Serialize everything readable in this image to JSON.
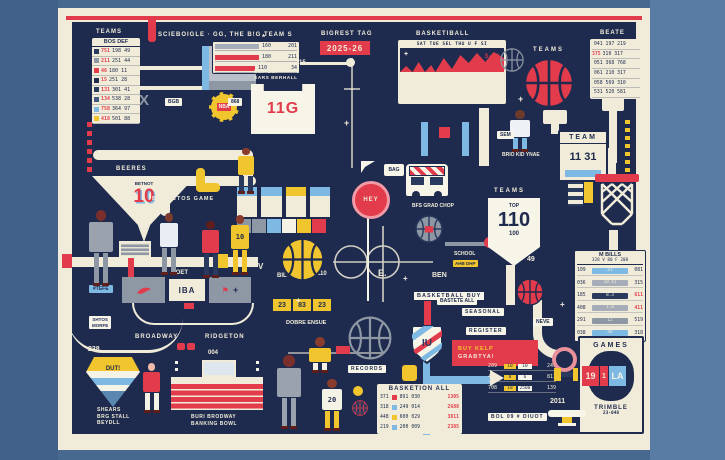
{
  "palette": {
    "bg": "#48698f",
    "bg_left": "#41618a",
    "bg_right": "#587ca4",
    "cream": "#f1ecd9",
    "navy": "#1e2b4e",
    "navy2": "#2a3a5e",
    "red": "#e23b4b",
    "yellow": "#f1c52e",
    "blue": "#7db9e3",
    "gray": "#a6adb8",
    "slate": "#8e97a4",
    "white": "#f7f4e8",
    "pink": "#f09aa5"
  },
  "top_left": {
    "title": "TEAMS",
    "header": "BOS DEF",
    "rows": [
      {
        "sw": "#2a3a5e",
        "n": "751",
        "v": "198 49"
      },
      {
        "sw": "#8e97a4",
        "n": "211",
        "v": "251 44"
      },
      {
        "sw": "#e23b4b",
        "n": "46",
        "v": "180 11"
      },
      {
        "sw": "#1e2b4e",
        "n": "15",
        "v": "251 28"
      },
      {
        "sw": "#2a3a5e",
        "n": "131",
        "v": "301 41"
      },
      {
        "sw": "#44597e",
        "n": "134",
        "v": "538 28"
      },
      {
        "sw": "#7db9e3",
        "n": "758",
        "v": "364 97"
      },
      {
        "sw": "#f1c52e",
        "n": "418",
        "v": "501 88"
      }
    ]
  },
  "schedule": "SCIEBOIGLE ·",
  "big_team": {
    "title": "GG, THE B!G TEAM S",
    "rows": [
      {
        "w": 44,
        "c": "#a6adb8",
        "label": "160",
        "value": "201"
      },
      {
        "w": 44,
        "c": "#e23b4b",
        "label": "180",
        "value": "211"
      },
      {
        "w": 40,
        "c": "#e23b4b",
        "label": "110",
        "value": "34"
      }
    ]
  },
  "bigrest": {
    "label": "BIGREST TAG",
    "value": "2025-26"
  },
  "jersey": {
    "cap1": "BGF BGI",
    "cap2": "SARS BERHALL",
    "num": "11G",
    "ln": "20",
    "rn": "15"
  },
  "nba": "NBA",
  "calendar": {
    "title": "BASKETIBALL",
    "days": "SAT TUE SEL THU U F SI",
    "note": "3-42",
    "rows": [
      "209 211 18 64 241 688",
      "304 511 56 89 408 257",
      "519 529 21 25 239 259",
      "060 358 48 81 340 201"
    ]
  },
  "teams_ball": "TEAMS",
  "beate": {
    "title": "BEATE",
    "rows": [
      {
        "pre": "",
        "rest": "041 197 219"
      },
      {
        "pre": "375",
        "rest": "310 317"
      },
      {
        "pre": "",
        "rest": "051 368 768"
      },
      {
        "pre": "",
        "rest": "061 210 317"
      },
      {
        "pre": "",
        "rest": "058 569 310"
      },
      {
        "pre": "",
        "rest": "531 520 581"
      }
    ]
  },
  "team_score": {
    "title": "TEAM",
    "score": "11 31"
  },
  "player_tag": "BRIO KID YNAE",
  "funnel": {
    "cap": "BEERES",
    "sub": "BETNOT",
    "num": "10"
  },
  "ban_etos": "BAN! ETOS GAME",
  "hey": "HEY",
  "bag": "BAG",
  "bus_label": "BFS GRAD CHOP",
  "tag110": {
    "title": "TEAMS",
    "top": "TOP",
    "num": "110",
    "bottom": "100"
  },
  "m_bills": {
    "title": "M BILLS",
    "head": "328 V 80 F 208",
    "rows": [
      {
        "l": "109",
        "c": "41",
        "cc": "#7db9e3",
        "r": "081"
      },
      {
        "l": "036",
        "c": "10.41",
        "cc": "#a6adb8",
        "r": "315"
      },
      {
        "l": "185",
        "c": "8.3",
        "cc": "#2a3a5e",
        "r": "611",
        "red": true
      },
      {
        "l": "408",
        "c": "1.0",
        "cc": "#a6adb8",
        "r": "411",
        "red": true
      },
      {
        "l": "291",
        "c": "12",
        "cc": "#8e97a4",
        "r": "519"
      },
      {
        "l": "038",
        "c": "40",
        "cc": "#7db9e3",
        "r": "318"
      }
    ]
  },
  "ball_labels": {
    "left": "BIL",
    "right": "110"
  },
  "buy_label": "BASKETBALL BUY",
  "school": {
    "line": "SCHOOL",
    "tag": "AHB DHP"
  },
  "records": "RECORDS",
  "score_strip": {
    "a": "23",
    "b": "83",
    "c": "23"
  },
  "dobre": "DOBRE ENSUE",
  "shield_text": "IU",
  "seasonal": "SEASONAL",
  "register": "REGISTER",
  "banner": {
    "l1": "BUY KELP",
    "l2": "GRABTYA!"
  },
  "legend": {
    "title": "BASKETION ALL",
    "rows": [
      {
        "a": "371",
        "sw": "#e23b4b",
        "b": "891",
        "c": "030",
        "d": "1305"
      },
      {
        "a": "318",
        "sw": "#7db9e3",
        "b": "249",
        "c": "014",
        "d": "2688"
      },
      {
        "a": "448",
        "sw": "#f1c52e",
        "b": "600",
        "c": "029",
        "d": "3811"
      },
      {
        "a": "219",
        "sw": "#7db9e3",
        "b": "200",
        "c": "009",
        "d": "2385"
      }
    ]
  },
  "stat_bars": [
    {
      "a": "209",
      "t1": "10",
      "t2": "10",
      "d": "249"
    },
    {
      "a": "461",
      "t1": "8",
      "t2": "6",
      "d": "811"
    },
    {
      "a": "708",
      "t1": "18",
      "t2": "2508",
      "d": "139"
    }
  ],
  "games": {
    "title": "GAMES",
    "home": "19",
    "mid": "1",
    "away": "LA",
    "note": "TRIMBLE",
    "code": "23-048"
  },
  "court": {
    "label": "FOET",
    "center": "IBA",
    "left": "BROADWAY",
    "right": "RIDGETON"
  },
  "diamond": "DUT!",
  "bottom_left_text": [
    "SHEARS",
    "BRG STALL",
    "BEYDLL"
  ],
  "bottom_right_text": [
    "BURI BRODWAY",
    "BANKING BOWL"
  ],
  "bol": "BOL 09 # DIUOT",
  "chip_blue": "#TEFE",
  "sign": [
    "SHTOS",
    "MORFE"
  ],
  "figures": [
    {
      "x": 86,
      "y": 210,
      "w": 30,
      "h": 76,
      "skin": "#7a2f2c",
      "shirt": "#9aa3ad",
      "pants": "#8e97a4",
      "num": ""
    },
    {
      "x": 157,
      "y": 213,
      "w": 24,
      "h": 62,
      "skin": "#7a3a2e",
      "shirt": "#e8eef4",
      "pants": "#8e97a4",
      "num": ""
    },
    {
      "x": 199,
      "y": 221,
      "w": 23,
      "h": 57,
      "skin": "#5e1f1c",
      "shirt": "#e23b4b",
      "pants": "#2a3a5e",
      "num": ""
    },
    {
      "x": 228,
      "y": 215,
      "w": 24,
      "h": 60,
      "skin": "#8a3c2c",
      "shirt": "#f1c52e",
      "pants": "#f1c52e",
      "num": "10"
    },
    {
      "x": 236,
      "y": 148,
      "w": 20,
      "h": 46,
      "skin": "#8a3c2c",
      "shirt": "#f1c52e",
      "pants": "#2a3a5e",
      "num": ""
    },
    {
      "x": 507,
      "y": 110,
      "w": 26,
      "h": 42,
      "skin": "#6b3a2a",
      "shirt": "#eef2f6",
      "pants": "#7db9e3",
      "num": ""
    },
    {
      "x": 273,
      "y": 355,
      "w": 32,
      "h": 74,
      "skin": "#7a2f2c",
      "shirt": "#9aa3ad",
      "pants": "#9aa3ad",
      "num": ""
    },
    {
      "x": 319,
      "y": 379,
      "w": 26,
      "h": 52,
      "skin": "#8a3c2c",
      "shirt": "#f5f2e6",
      "pants": "#f1c52e",
      "num": "20"
    },
    {
      "x": 306,
      "y": 337,
      "w": 28,
      "h": 36,
      "skin": "#8a3c2c",
      "shirt": "#f1c52e",
      "pants": "#f5f2e6",
      "num": ""
    },
    {
      "x": 141,
      "y": 363,
      "w": 21,
      "h": 50,
      "skin": "#f0b9a8",
      "shirt": "#e23b4b",
      "pants": "#f5f2e6",
      "num": ""
    }
  ],
  "balls": [
    {
      "x": 523,
      "y": 57,
      "d": 52,
      "fill": "#e23b4b",
      "seam": "#1e2b4e"
    },
    {
      "x": 500,
      "y": 48,
      "d": 24,
      "fill": "none",
      "seam": "#8e97a4"
    },
    {
      "x": 280,
      "y": 237,
      "d": 45,
      "fill": "#f1c52e",
      "seam": "#1e2b4e"
    },
    {
      "x": 415,
      "y": 215,
      "d": 28,
      "fill": "#8e97a4",
      "seam": "#2a3a5e",
      "patch": "#e23b4b"
    },
    {
      "x": 348,
      "y": 316,
      "d": 44,
      "fill": "none",
      "seam": "#8e97a4"
    },
    {
      "x": 352,
      "y": 400,
      "d": 16,
      "fill": "#2a3a5e",
      "seam": "#e23b4b"
    },
    {
      "x": 516,
      "y": 278,
      "d": 28,
      "fill": "#e23b4b",
      "seam": "#1e2b4e"
    }
  ],
  "pipes": [
    {
      "x": 66,
      "y": 16,
      "w": 576,
      "h": 4,
      "c": "#e23b4b"
    },
    {
      "x": 148,
      "y": 16,
      "w": 8,
      "h": 26,
      "c": "#e23b4b",
      "r": "3px"
    },
    {
      "x": 87,
      "y": 122,
      "w": 5,
      "h": 52,
      "c": "repeating-linear-gradient(180deg,#e23b4b 0 5px,rgba(0,0,0,0) 5px 9px)"
    },
    {
      "x": 140,
      "y": 66,
      "w": 62,
      "h": 4,
      "c": "#f1ecd9"
    },
    {
      "x": 140,
      "y": 86,
      "w": 62,
      "h": 4,
      "c": "#f1ecd9"
    },
    {
      "x": 294,
      "y": 62,
      "w": 54,
      "h": 3,
      "c": "#f1ecd9"
    },
    {
      "x": 346,
      "y": 58,
      "w": 9,
      "h": 9,
      "c": "#f1ecd9",
      "r": "50%"
    },
    {
      "x": 93,
      "y": 150,
      "w": 160,
      "h": 10,
      "c": "#f1ecd9",
      "r": "5px"
    },
    {
      "x": 243,
      "y": 150,
      "w": 10,
      "h": 36,
      "c": "#f1ecd9",
      "r": "5px"
    },
    {
      "x": 160,
      "y": 176,
      "w": 96,
      "h": 10,
      "c": "#f1ecd9",
      "r": "5px"
    },
    {
      "x": 160,
      "y": 176,
      "w": 10,
      "h": 40,
      "c": "#f1ecd9",
      "r": "5px"
    },
    {
      "x": 196,
      "y": 168,
      "w": 9,
      "h": 24,
      "c": "#f1c52e",
      "r": "4px"
    },
    {
      "x": 196,
      "y": 183,
      "w": 24,
      "h": 9,
      "c": "#f1c52e",
      "r": "4px"
    },
    {
      "x": 58,
      "y": 257,
      "w": 200,
      "h": 10,
      "c": "#f1ecd9"
    },
    {
      "x": 62,
      "y": 254,
      "w": 10,
      "h": 14,
      "c": "#e23b4b"
    },
    {
      "x": 216,
      "y": 254,
      "w": 12,
      "h": 14,
      "c": "#f1c52e"
    },
    {
      "x": 128,
      "y": 255,
      "w": 6,
      "h": 46,
      "c": "#e23b4b"
    },
    {
      "x": 367,
      "y": 213,
      "w": 2,
      "h": 88,
      "c": "#f7f4e8"
    },
    {
      "x": 543,
      "y": 110,
      "w": 24,
      "h": 14,
      "c": "#f1ecd9",
      "r": "2px"
    },
    {
      "x": 551,
      "y": 124,
      "w": 8,
      "h": 10,
      "c": "#f1ecd9"
    },
    {
      "x": 602,
      "y": 97,
      "w": 22,
      "h": 14,
      "c": "#f1ecd9",
      "r": "2px"
    },
    {
      "x": 609,
      "y": 111,
      "w": 8,
      "h": 52,
      "c": "#f1ecd9"
    },
    {
      "x": 606,
      "y": 148,
      "w": 10,
      "h": 28,
      "c": "#f1ecd9"
    },
    {
      "x": 609,
      "y": 230,
      "w": 9,
      "h": 34,
      "c": "#f1ecd9"
    },
    {
      "x": 584,
      "y": 176,
      "w": 9,
      "h": 27,
      "c": "#f1c52e"
    },
    {
      "x": 568,
      "y": 176,
      "w": 15,
      "h": 30,
      "c": "repeating-linear-gradient(180deg,#f1ecd9 0 4px,#2a3a5e 4px 8px)"
    },
    {
      "x": 506,
      "y": 265,
      "w": 9,
      "h": 40,
      "c": "#f1ecd9"
    },
    {
      "x": 445,
      "y": 242,
      "w": 46,
      "h": 4,
      "c": "#8e97a4"
    },
    {
      "x": 484,
      "y": 237,
      "w": 11,
      "h": 11,
      "c": "#e23b4b",
      "r": "50%"
    },
    {
      "x": 421,
      "y": 122,
      "w": 7,
      "h": 34,
      "c": "#7db9e3"
    },
    {
      "x": 462,
      "y": 122,
      "w": 7,
      "h": 34,
      "c": "#7db9e3"
    },
    {
      "x": 439,
      "y": 127,
      "w": 11,
      "h": 11,
      "c": "#e23b4b"
    },
    {
      "x": 479,
      "y": 108,
      "w": 10,
      "h": 58,
      "c": "#f1ecd9"
    },
    {
      "x": 424,
      "y": 297,
      "w": 7,
      "h": 28,
      "c": "#e23b4b"
    },
    {
      "x": 423,
      "y": 360,
      "w": 7,
      "h": 75,
      "c": "#7db9e3"
    },
    {
      "x": 430,
      "y": 376,
      "w": 60,
      "h": 8,
      "c": "#7db9e3"
    },
    {
      "x": 351,
      "y": 58,
      "w": 2,
      "h": 110,
      "c": "rgba(241,236,217,.65)"
    },
    {
      "x": 344,
      "y": 88,
      "w": 16,
      "h": 2,
      "c": "rgba(241,236,217,.65)"
    },
    {
      "x": 288,
      "y": 352,
      "w": 95,
      "h": 2,
      "c": "rgba(241,236,217,.55)"
    },
    {
      "x": 625,
      "y": 120,
      "w": 5,
      "h": 52,
      "c": "repeating-linear-gradient(180deg,#f1c52e 0 4px,rgba(0,0,0,0) 4px 8px)"
    },
    {
      "x": 626,
      "y": 250,
      "w": 5,
      "h": 55,
      "c": "repeating-linear-gradient(180deg,#f1c52e 0 4px,rgba(0,0,0,0) 4px 8px)"
    },
    {
      "x": 336,
      "y": 346,
      "w": 14,
      "h": 8,
      "c": "#e23b4b",
      "r": "1px"
    },
    {
      "x": 402,
      "y": 365,
      "w": 15,
      "h": 16,
      "c": "#f1c52e",
      "r": "3px"
    },
    {
      "x": 353,
      "y": 386,
      "w": 10,
      "h": 10,
      "c": "#f1c52e",
      "r": "50%"
    },
    {
      "x": 184,
      "y": 302,
      "w": 10,
      "h": 7,
      "c": "#e23b4b"
    }
  ],
  "decorations": [
    {
      "t": "X",
      "x": 139,
      "y": 92,
      "c": "#8e97a4",
      "s": 15
    },
    {
      "t": "*",
      "x": 262,
      "y": 33,
      "c": "#f1ecd9",
      "s": 8
    },
    {
      "t": "+",
      "x": 344,
      "y": 118,
      "c": "#f1ecd9",
      "s": 9
    },
    {
      "t": "+",
      "x": 518,
      "y": 94,
      "c": "#f1ecd9",
      "s": 9
    },
    {
      "t": "+",
      "x": 403,
      "y": 274,
      "c": "#f1ecd9",
      "s": 8
    },
    {
      "t": "E.",
      "x": 378,
      "y": 268,
      "c": "#f1ecd9",
      "s": 9
    },
    {
      "t": "BEN",
      "x": 432,
      "y": 272,
      "c": "#f1ecd9",
      "s": 7
    },
    {
      "t": "49",
      "x": 527,
      "y": 256,
      "c": "#f1ecd9",
      "s": 7
    },
    {
      "t": "2011",
      "x": 550,
      "y": 398,
      "c": "#f1ecd9",
      "s": 7
    },
    {
      "t": "238",
      "x": 88,
      "y": 346,
      "c": "#f1ecd9",
      "s": 7
    },
    {
      "t": "004",
      "x": 208,
      "y": 350,
      "c": "#f1ecd9",
      "s": 6
    },
    {
      "t": "V",
      "x": 258,
      "y": 262,
      "c": "#f1ecd9",
      "s": 8
    },
    {
      "t": "+",
      "x": 296,
      "y": 296,
      "c": "#f1ecd9",
      "s": 8
    },
    {
      "t": "+",
      "x": 560,
      "y": 300,
      "c": "#f1ecd9",
      "s": 8
    }
  ],
  "chips": [
    {
      "t": "BGB",
      "x": 165,
      "y": 98
    },
    {
      "t": "868",
      "x": 228,
      "y": 98
    },
    {
      "t": "SEM",
      "x": 497,
      "y": 131
    },
    {
      "t": "NEVE",
      "x": 533,
      "y": 318
    },
    {
      "t": "BASTETE ALL",
      "x": 437,
      "y": 297
    }
  ]
}
